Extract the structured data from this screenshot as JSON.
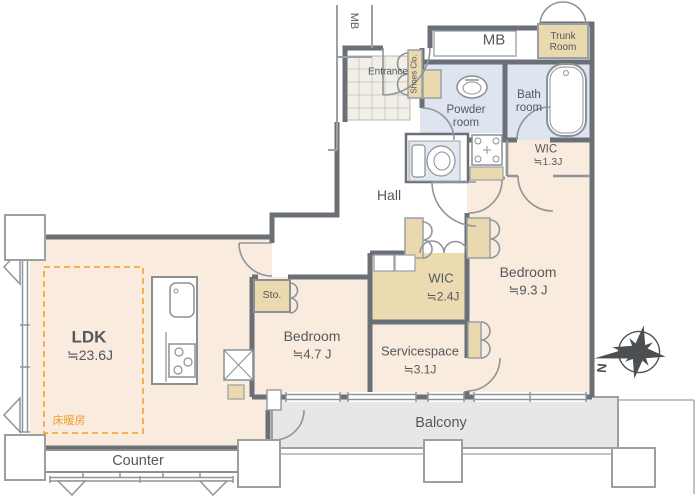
{
  "rooms": {
    "ldk": {
      "name": "LDK",
      "size": "≒23.6J"
    },
    "bedroom_main": {
      "name": "Bedroom",
      "size": "≒9.3 J"
    },
    "bedroom_small": {
      "name": "Bedroom",
      "size": "≒4.7 J"
    },
    "servicespace": {
      "name": "Servicespace",
      "size": "≒3.1J"
    },
    "wic_large": {
      "name": "WIC",
      "size": "≒2.4J"
    },
    "wic_small": {
      "name": "WIC",
      "size": "≒1.3J"
    },
    "hall": {
      "name": "Hall"
    },
    "entrance": {
      "name": "Entrance"
    },
    "shoes_closet": {
      "name": "Shoes Clo."
    },
    "powder_room": {
      "name": "Powder room"
    },
    "bath_room": {
      "name": "Bath room"
    },
    "trunk_room": {
      "name": "Trunk Room"
    },
    "storage": {
      "name": "Sto."
    },
    "balcony": {
      "name": "Balcony"
    },
    "counter": {
      "name": "Counter"
    },
    "meter_box_top": {
      "name": "MB"
    },
    "meter_box_shaft": {
      "name": "MB"
    }
  },
  "annotations": {
    "floor_heating": "床暖房",
    "compass_north": "N"
  },
  "colors": {
    "floor_peach": "#f9ebde",
    "closet_beige": "#ead9ae",
    "wet_area_blue": "#dfe5f0",
    "balcony_gray": "#e7e7e7",
    "wall_gray": "#6a7075",
    "heating_orange": "#f2a33c"
  }
}
